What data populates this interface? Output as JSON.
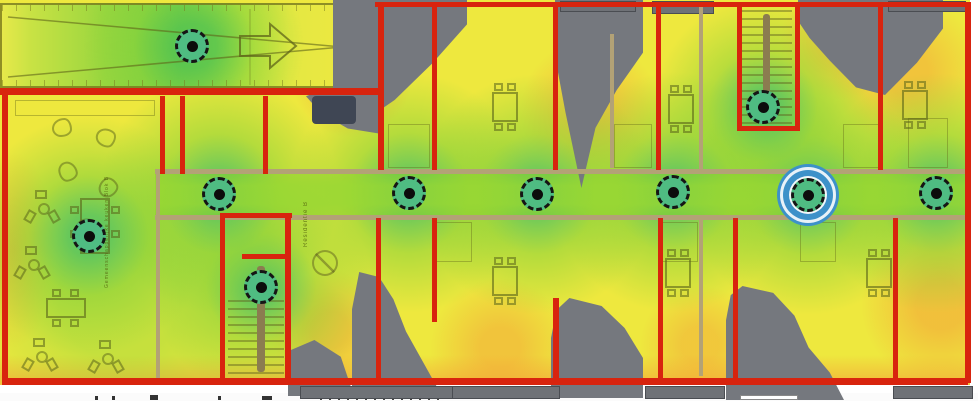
{
  "floorplan": {
    "labels": {
      "residentie": "Residentie B",
      "common_room": "Gemeenschappelijke keuken Blok B"
    },
    "access_points": {
      "count": 10,
      "selected_count": 1,
      "markers": [
        {
          "x": 192,
          "y": 46,
          "selected": false
        },
        {
          "x": 89,
          "y": 236,
          "selected": false
        },
        {
          "x": 219,
          "y": 194,
          "selected": false
        },
        {
          "x": 261,
          "y": 287,
          "selected": false
        },
        {
          "x": 409,
          "y": 193,
          "selected": false
        },
        {
          "x": 537,
          "y": 194,
          "selected": false
        },
        {
          "x": 673,
          "y": 192,
          "selected": false
        },
        {
          "x": 763,
          "y": 107,
          "selected": false
        },
        {
          "x": 808,
          "y": 195,
          "selected": true
        },
        {
          "x": 936,
          "y": 193,
          "selected": false
        }
      ]
    },
    "colors": {
      "signal_strong_green": "#54bd82",
      "signal_good_green": "#8ed63e",
      "signal_fair_yellow": "#efe93e",
      "signal_weak_orange": "#f4a038",
      "no_coverage_gray": "#75787e",
      "boundary_wall_red": "#d8240e",
      "interior_wall_tan": "#b3a276",
      "selected_ring_blue": "#3d91c9"
    }
  }
}
